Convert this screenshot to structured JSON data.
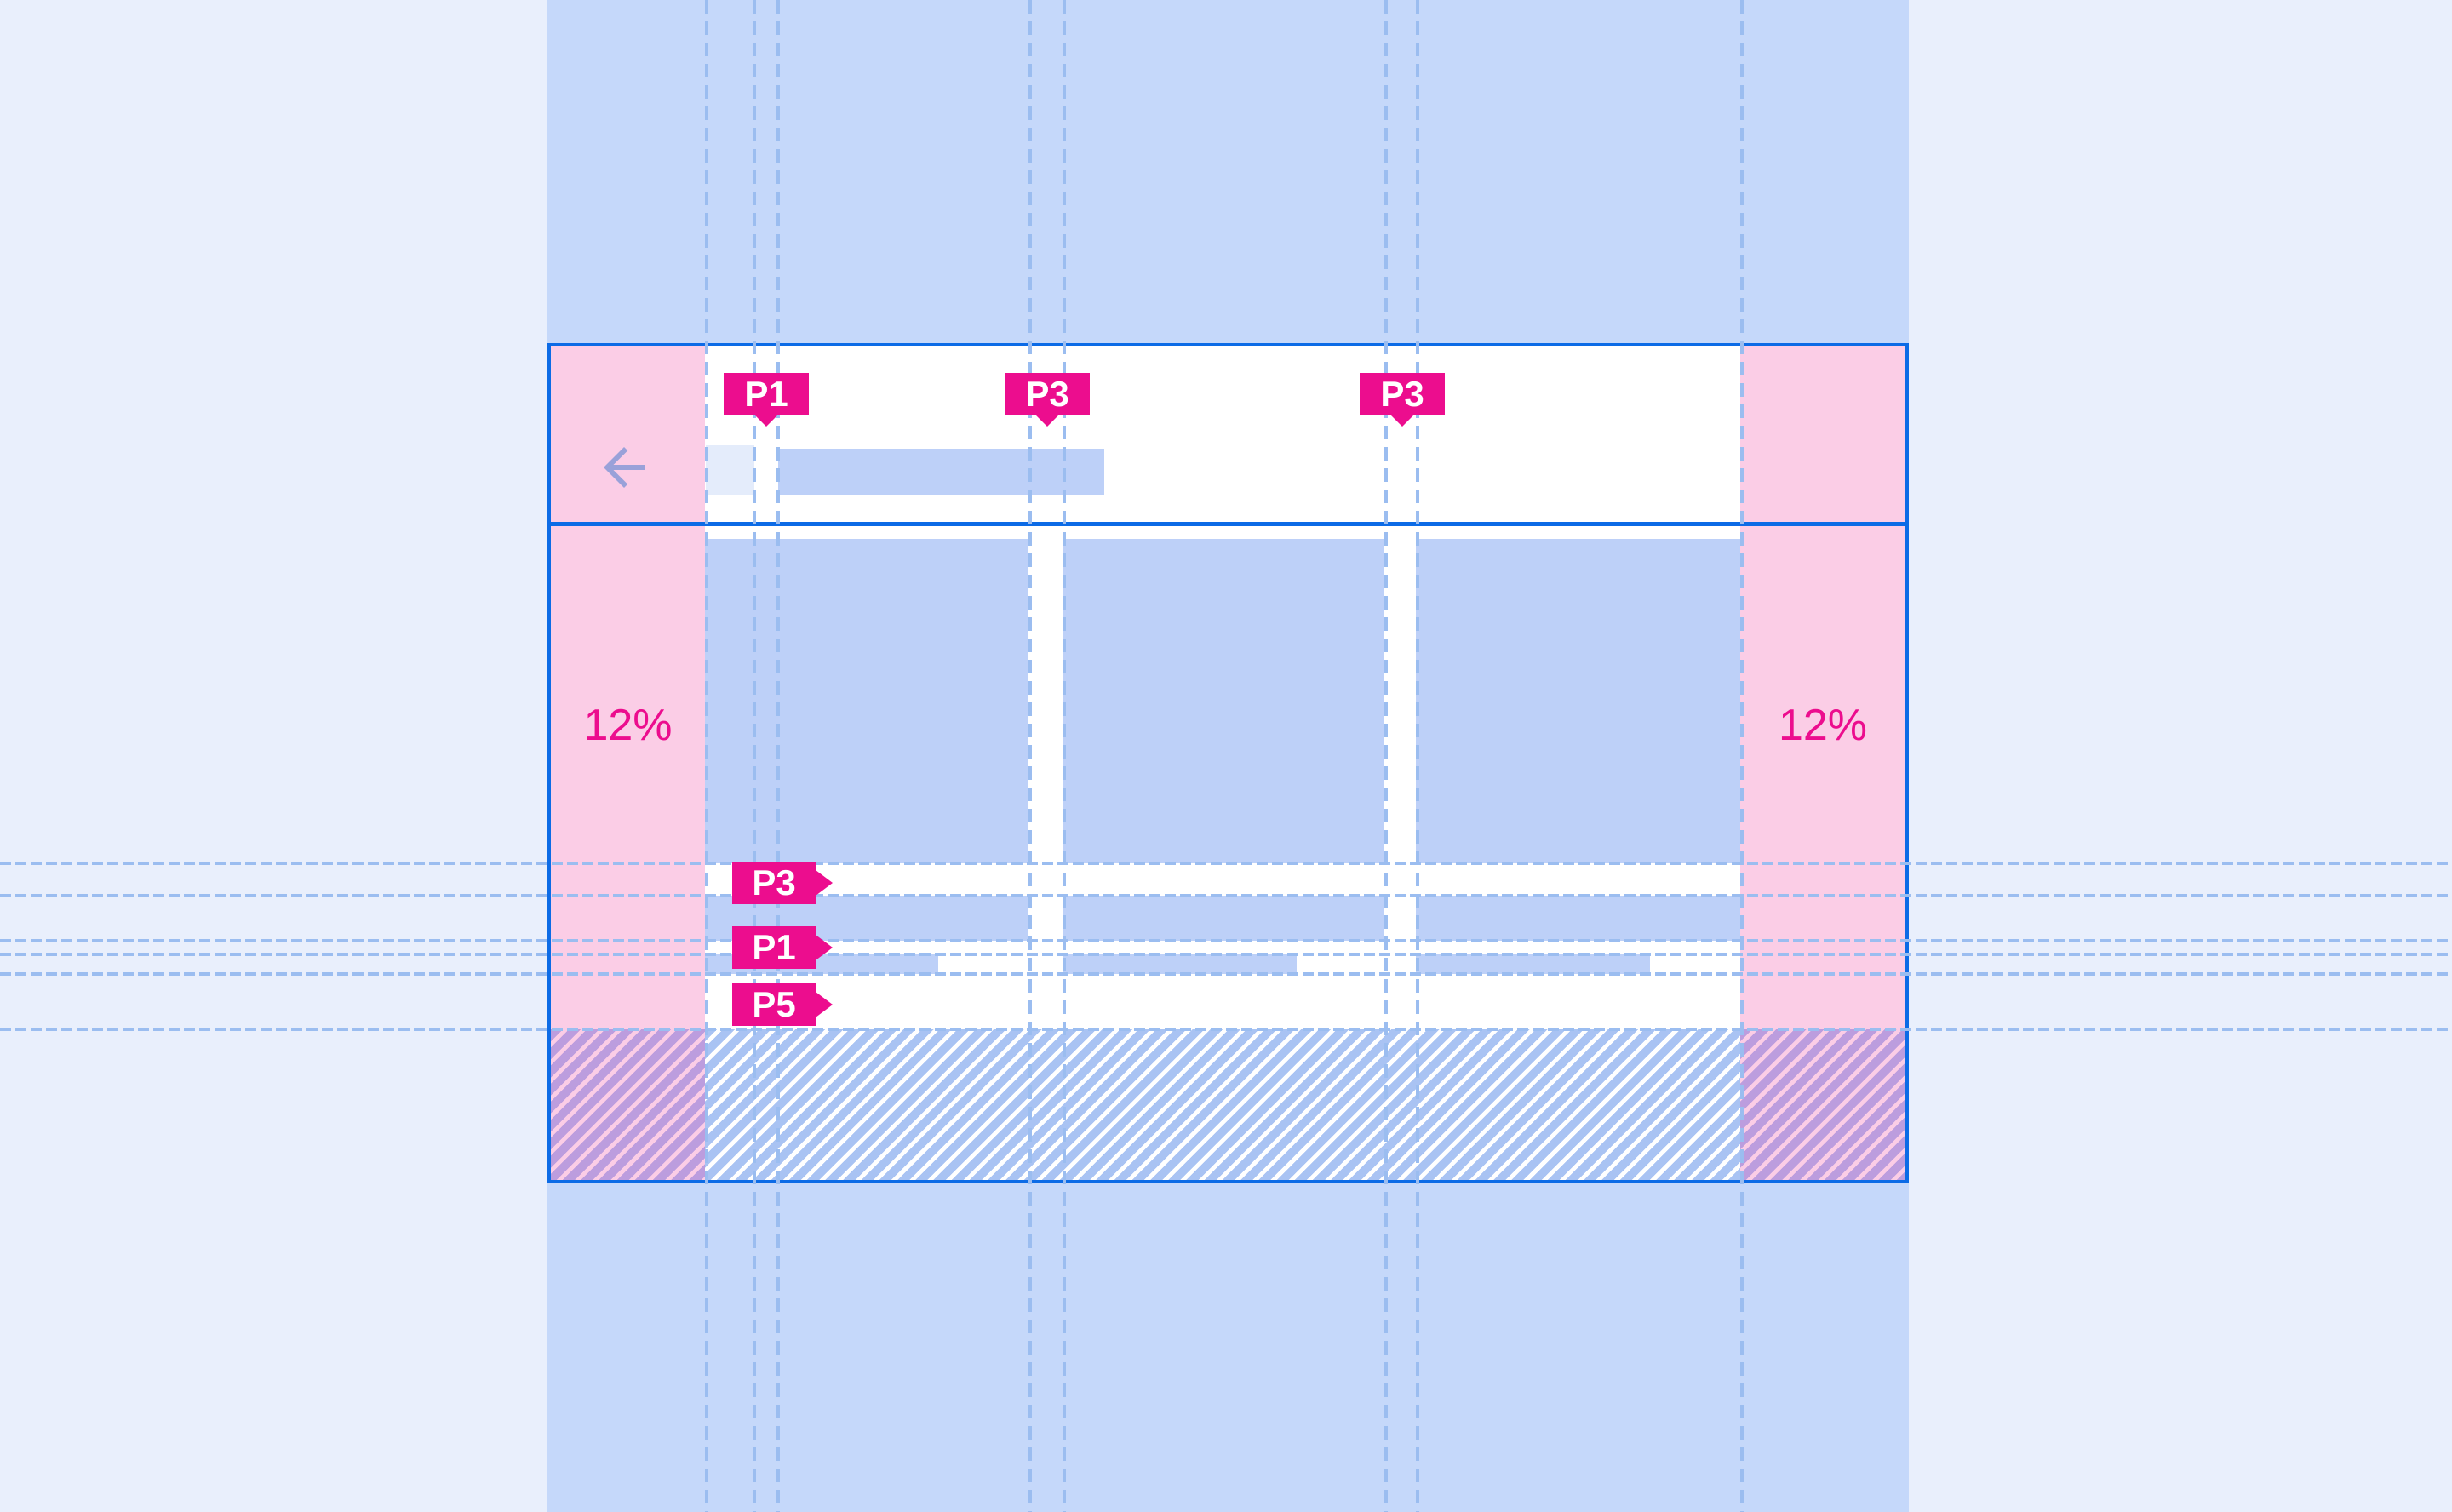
{
  "colors": {
    "page_bg": "#E9EFFC",
    "band": "#C5D8FA",
    "border_blue": "#0C6BE6",
    "pink": "#FBCDE6",
    "magenta": "#EC0D8E",
    "fill_blue": "#BDD0F8",
    "icon_fill": "#E4ECFB",
    "arrow": "#99A1D9",
    "guide": "#9BBDF0",
    "hatch_blue": "#A9C3F3",
    "hatch_purple": "#BC9DDE"
  },
  "margins": {
    "left_label": "12%",
    "right_label": "12%"
  },
  "top_tags": [
    {
      "label": "P1"
    },
    {
      "label": "P3"
    },
    {
      "label": "P3"
    }
  ],
  "side_tags": [
    {
      "label": "P3"
    },
    {
      "label": "P1"
    },
    {
      "label": "P5"
    }
  ],
  "icons": {
    "back_arrow": "arrow-left"
  }
}
